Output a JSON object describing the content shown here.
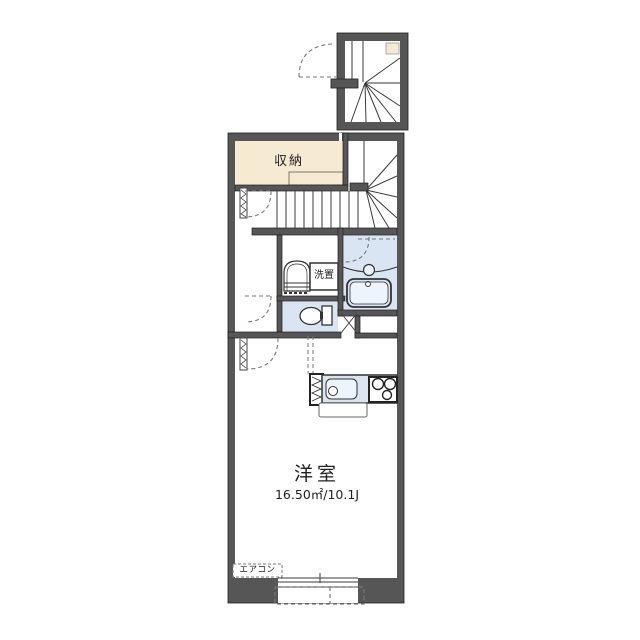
{
  "floor_plan": {
    "labels": {
      "closet": "収納",
      "washer_place": "洗置",
      "main_room": "洋室",
      "main_room_area": "16.50㎡/10.1J",
      "aircon": "エアコン"
    },
    "rooms": [
      {
        "name": "closet",
        "label": "収納"
      },
      {
        "name": "washer-place",
        "label": "洗置"
      },
      {
        "name": "western-room",
        "label": "洋室",
        "area": "16.50㎡/10.1J"
      },
      {
        "name": "air-conditioner",
        "label": "エアコン"
      }
    ]
  },
  "colors": {
    "wall": "#565656",
    "cream": "#f6ebd2",
    "blue": "#d9e5f3",
    "bluelight": "#eef4fb",
    "line": "#3a3a3a",
    "dash": "#777777",
    "text": "#222222"
  }
}
